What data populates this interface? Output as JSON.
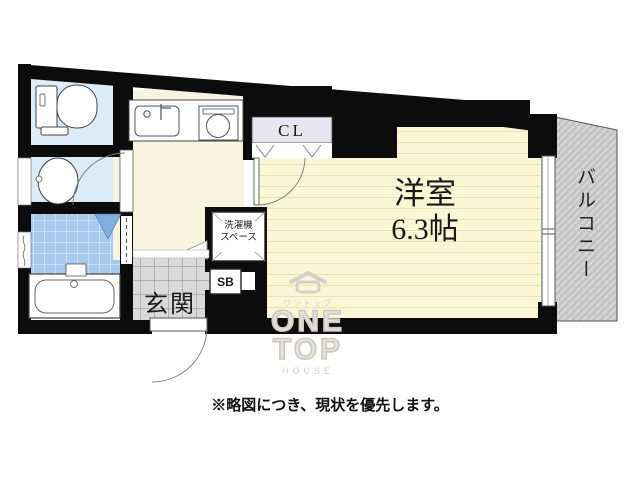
{
  "rooms": {
    "main_room": {
      "name": "洋室",
      "size": "6.3帖"
    },
    "balcony": {
      "label": "バルコニー"
    },
    "closet": {
      "label": "CL"
    },
    "entrance": {
      "label": "玄関"
    },
    "shoe_box": {
      "label": "SB"
    },
    "washer_space": {
      "line1": "洗濯機",
      "line2": "スペース"
    }
  },
  "note": "※略図につき、現状を優先します。",
  "watermark": {
    "brand_jp": "ワントップ",
    "word_one": "ONE",
    "word_top": "TOP",
    "word_house": "HOUSE"
  },
  "icons": {
    "toilet": "toilet-icon",
    "washbasin": "washbasin-icon",
    "bathtub": "bathtub-icon",
    "kitchen_sink": "kitchen-sink-icon",
    "stove": "stove-icon",
    "house_logo": "house-logo-icon"
  },
  "colors": {
    "wall": "#0c0c0c",
    "main_room_floor": "#fbf7d6",
    "floor_stripe": "#eae2b4",
    "corridor_floor": "#f7f4df",
    "wet_room_floor": "#dcebf6",
    "bath_tile": "#a6c9ec",
    "entrance_tile": "#d9d9d9",
    "balcony_fill": "#c4c4c4",
    "closet_bg": "#e7e5ef",
    "door_swing_blue": "#7fafdf"
  }
}
